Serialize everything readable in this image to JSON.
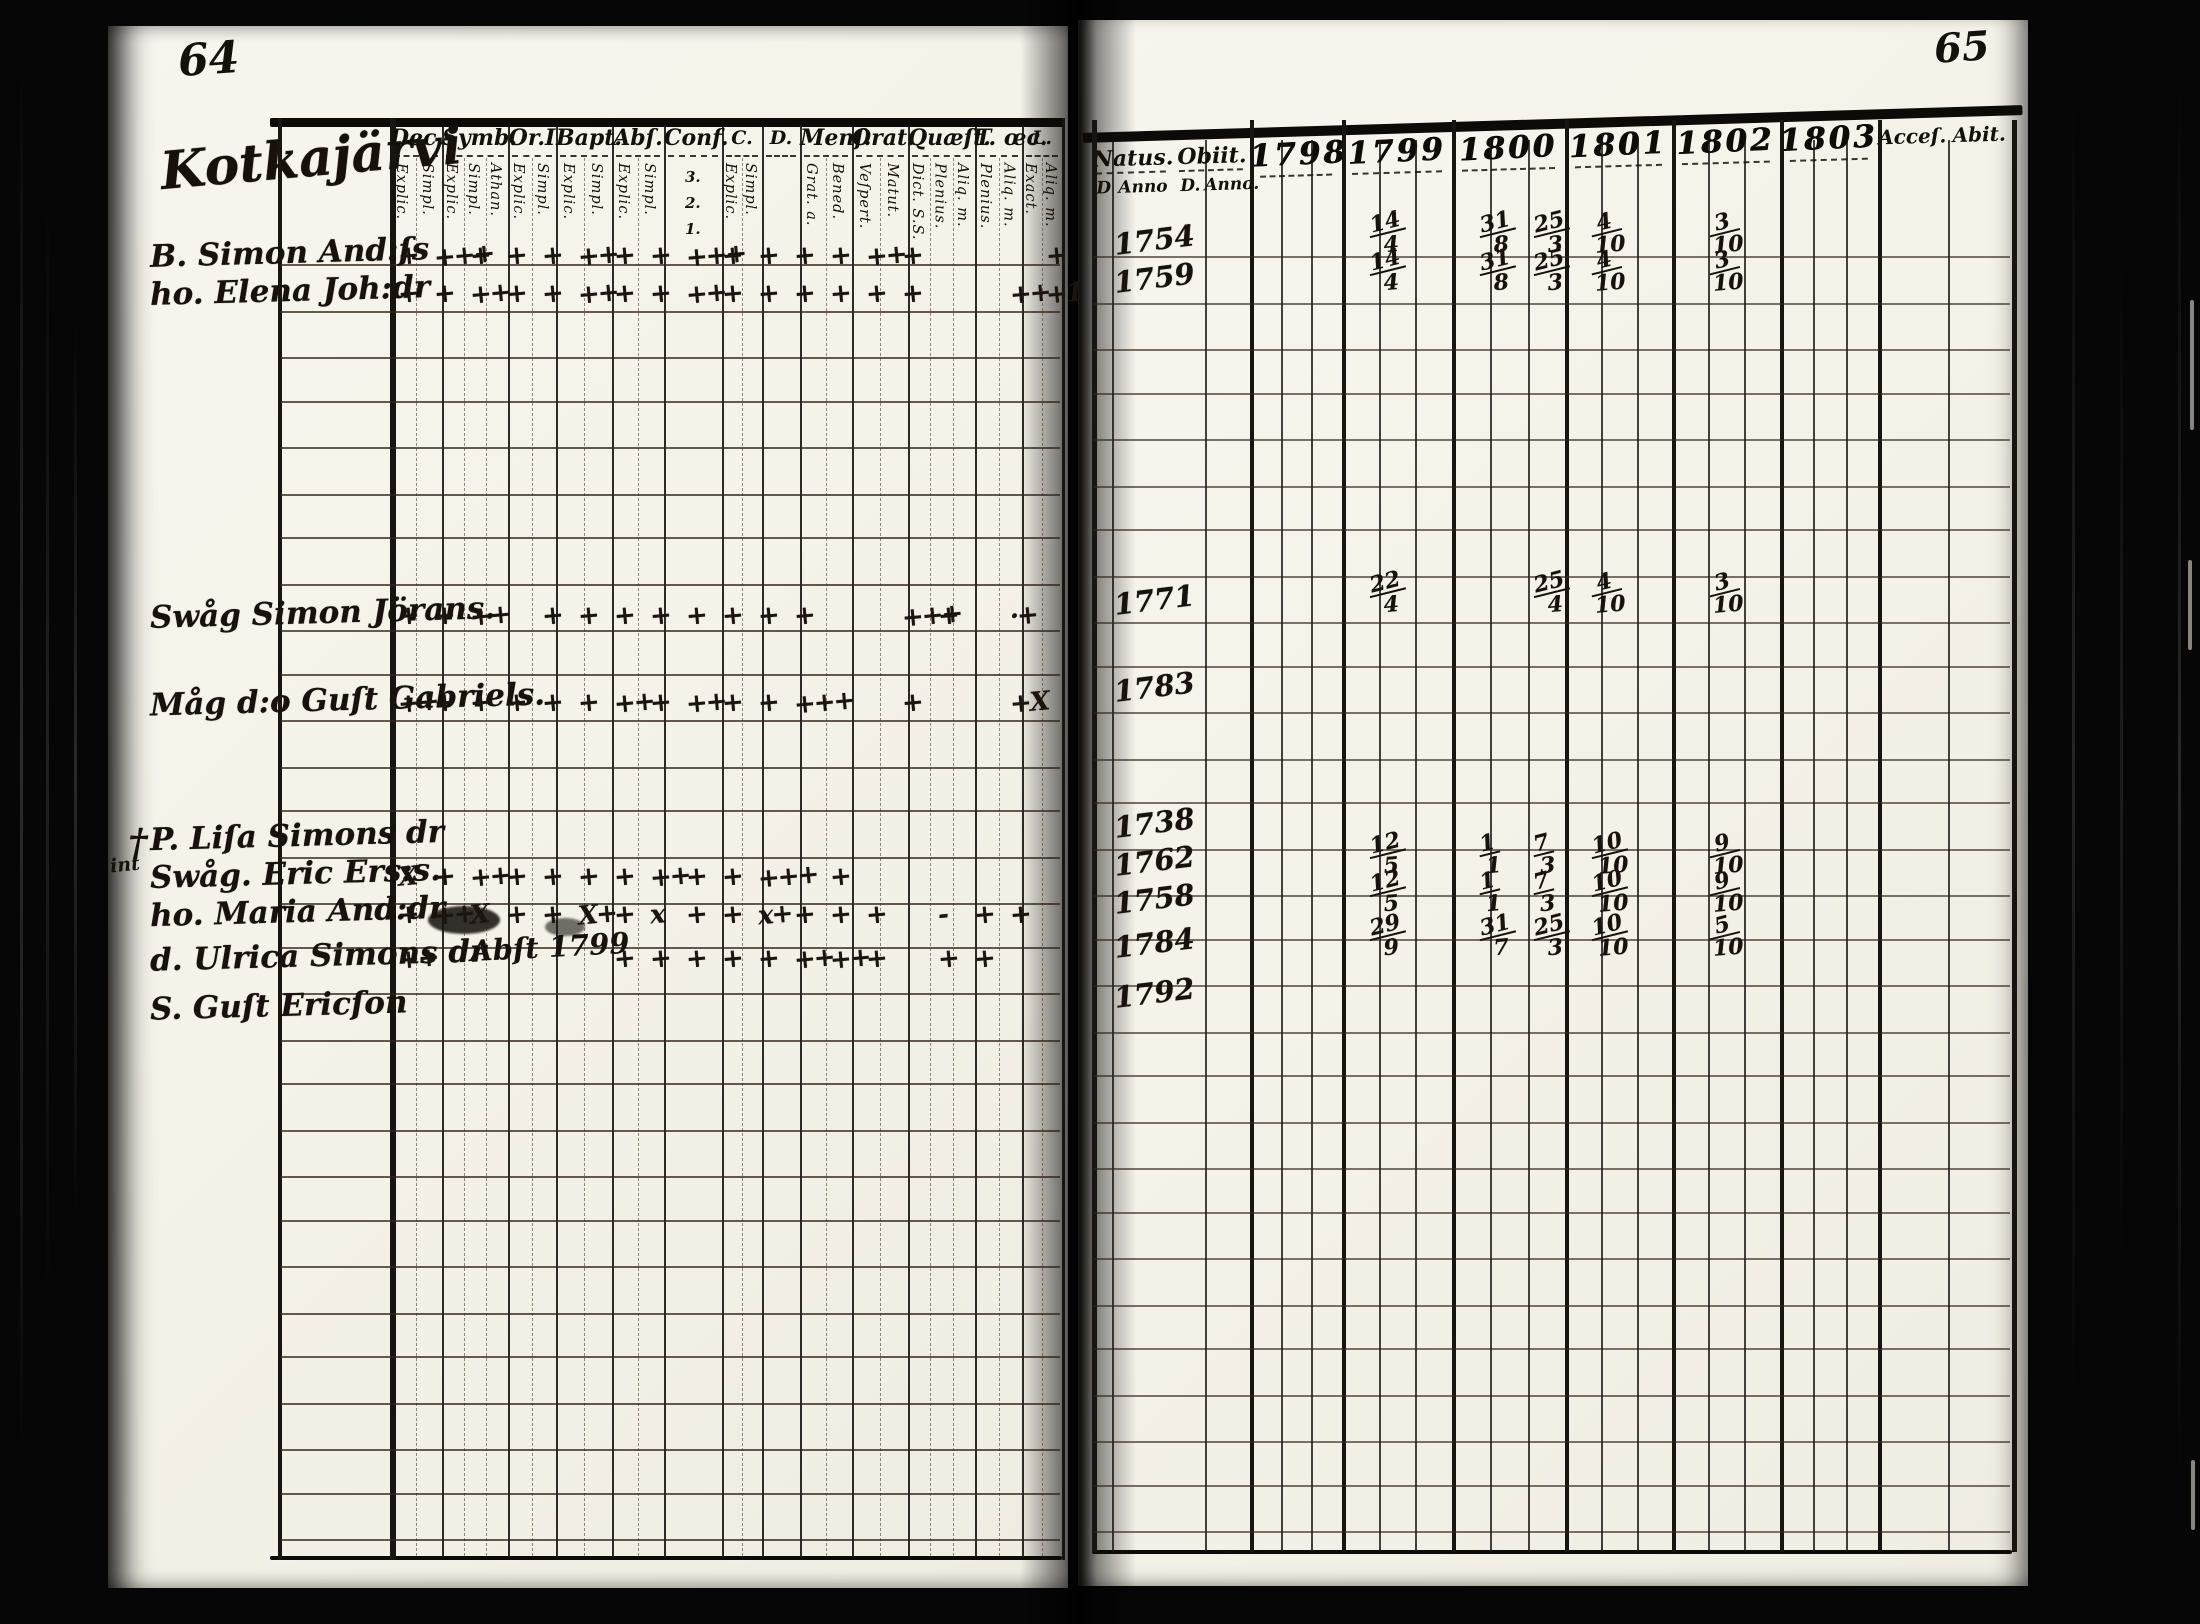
{
  "colors": {
    "paper": "#f6f4ec",
    "ink": "#17120c",
    "print": "#14100a",
    "background": "#060606"
  },
  "document": {
    "left_page": {
      "page_number": "64",
      "heading": "Kotkajärvi",
      "columns": [
        {
          "label": "Dec.",
          "subs": [
            "Explic.",
            "Simpl."
          ]
        },
        {
          "label": "Symb.",
          "subs": [
            "Explic.",
            "Simpl.",
            "Athan."
          ]
        },
        {
          "label": "Or.I",
          "subs": [
            "Explic.",
            "Simpl."
          ]
        },
        {
          "label": "Bapt.",
          "subs": [
            "Explic.",
            "Simpl."
          ]
        },
        {
          "label": "Abſ.",
          "subs": [
            "Explic.",
            "Simpl."
          ]
        },
        {
          "label": "Conf.",
          "subs": [
            "3.",
            "2.",
            "1."
          ]
        },
        {
          "label": "C.",
          "subs": [
            "Explic.",
            "Simpl."
          ]
        },
        {
          "label": "D.",
          "subs": []
        },
        {
          "label": "Menſ.",
          "subs": [
            "Grat. a.",
            "Bened."
          ]
        },
        {
          "label": "Orat.",
          "subs": [
            "Veſpert.",
            "Matut."
          ]
        },
        {
          "label": "Quæſt.",
          "subs": [
            "Dict. S.S.",
            "Plenius.",
            "Aliq. m."
          ]
        },
        {
          "label": "T. œc.",
          "subs": [
            "Plenius.",
            "Aliq. m."
          ]
        },
        {
          "label": "L.",
          "subs": [
            "Exact.",
            "Aliq. m."
          ]
        }
      ]
    },
    "right_page": {
      "page_number": "65",
      "natus_label": "Natus.",
      "natus_subs": [
        "D",
        "Anno"
      ],
      "obiit_label": "Obiit.",
      "obiit_subs": [
        "D.",
        "Anno."
      ],
      "years": [
        "1798",
        "1799",
        "1800",
        "1801",
        "1802",
        "1803"
      ],
      "acc_label": "Acceſ.",
      "abit_label": "Abit."
    },
    "rows": [
      {
        "name": "B. Simon And:ſs",
        "natus": "1754",
        "marks": [
          "+",
          "+++",
          "+",
          "+",
          "+",
          "++",
          "+",
          "+",
          "+++",
          "+",
          "+",
          "+",
          "+",
          "++",
          "+",
          "",
          "",
          "",
          "+"
        ],
        "dates": [
          {
            "col": "1799",
            "v": "14/4"
          },
          {
            "col": "1800a",
            "v": "31/8"
          },
          {
            "col": "1800b",
            "v": "25/3"
          },
          {
            "col": "1801",
            "v": "4/10"
          },
          {
            "col": "1802",
            "v": "3/10"
          }
        ]
      },
      {
        "name": "ho. Elena Joh:dr",
        "natus": "1759",
        "marks": [
          "+",
          "+",
          "++",
          "+",
          "+",
          "++",
          "+",
          "+",
          "++",
          "+",
          "+",
          "+",
          "+",
          "+",
          "+",
          "",
          "",
          "++",
          "+1"
        ],
        "dates": [
          {
            "col": "1799",
            "v": "14/4"
          },
          {
            "col": "1800a",
            "v": "31/8"
          },
          {
            "col": "1800b",
            "v": "25/3"
          },
          {
            "col": "1801",
            "v": "4/10"
          },
          {
            "col": "1802",
            "v": "3/10"
          }
        ]
      },
      {
        "name": "Swåg Simon Jörans.",
        "natus": "1771",
        "marks": [
          "+",
          "+",
          "++",
          "",
          "+",
          "+",
          "+",
          "+",
          "+",
          "+",
          "+",
          "+",
          "",
          "",
          "+++",
          "+",
          "",
          "·+",
          ""
        ],
        "dates": [
          {
            "col": "1799",
            "v": "22/4"
          },
          {
            "col": "1800b",
            "v": "25/4"
          },
          {
            "col": "1801",
            "v": "4/10"
          },
          {
            "col": "1802",
            "v": "3/10"
          }
        ]
      },
      {
        "name": "Måg d:o Guſt Gabriels.",
        "natus": "1783",
        "marks": [
          "++",
          "+",
          "+",
          "+",
          "+",
          "+",
          "++",
          "+",
          "++",
          "+",
          "+",
          "+++",
          "",
          "",
          "+",
          "",
          "",
          "+X",
          ""
        ],
        "dates": []
      },
      {
        "name": "P. Liſa Simons dr",
        "natus": "1738",
        "marks": [],
        "dates": []
      },
      {
        "name": "Swåg. Eric Ers:s.",
        "natus": "1762",
        "marks": [
          "X",
          "+",
          "++",
          "+",
          "+",
          "+",
          "+",
          "++",
          "+",
          "+",
          "+++",
          "",
          "+",
          "",
          "",
          "",
          "",
          "",
          ""
        ],
        "dates": [
          {
            "col": "1799",
            "v": "12/5"
          },
          {
            "col": "1800a",
            "v": "1/1"
          },
          {
            "col": "1800b",
            "v": "7/3"
          },
          {
            "col": "1801",
            "v": "10/10"
          },
          {
            "col": "1802",
            "v": "9/10"
          }
        ]
      },
      {
        "name": "ho. Maria And:dr",
        "natus": "1758",
        "marks": [
          "+",
          "++",
          "X",
          "+",
          "+",
          "X+",
          "+",
          "x",
          "+",
          "+",
          "x+",
          "+",
          "+",
          "+",
          "",
          "-",
          "+",
          "+",
          ""
        ],
        "dates": [
          {
            "col": "1799",
            "v": "12/5"
          },
          {
            "col": "1800a",
            "v": "1/1"
          },
          {
            "col": "1800b",
            "v": "7/3"
          },
          {
            "col": "1801",
            "v": "10/10"
          },
          {
            "col": "1802",
            "v": "9/10"
          }
        ]
      },
      {
        "name": "d. Ulrica Simons dr",
        "natus": "1784",
        "marks": [
          "++",
          "",
          "",
          "",
          "",
          "",
          "+",
          "+",
          "+",
          "+",
          "+",
          "++",
          "++",
          "+",
          "",
          "+",
          "+",
          "",
          ""
        ],
        "dates": [
          {
            "col": "1799",
            "v": "29/9"
          },
          {
            "col": "1800a",
            "v": "31/7"
          },
          {
            "col": "1800b",
            "v": "25/3"
          },
          {
            "col": "1801",
            "v": "10/10"
          },
          {
            "col": "1802",
            "v": "5/10"
          }
        ]
      },
      {
        "name": "S. Guſt Ericſon",
        "natus": "1792",
        "marks": [],
        "dates": []
      }
    ],
    "annotations": [
      {
        "text": "†"
      },
      {
        "text": "int"
      },
      {
        "text": "Abſt 1799"
      }
    ]
  }
}
